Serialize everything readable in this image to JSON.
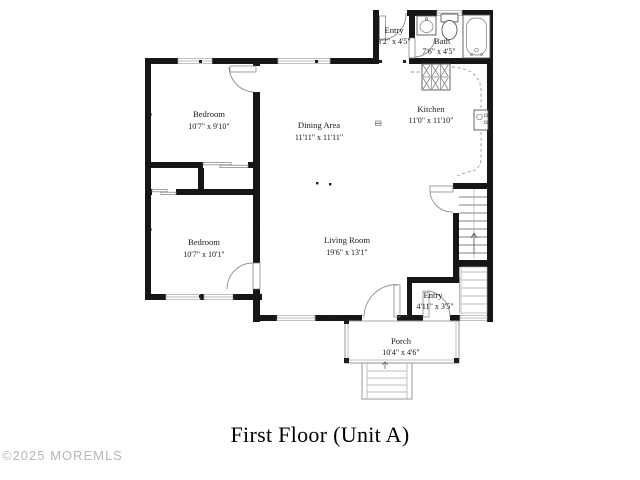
{
  "page": {
    "title": "First Floor (Unit A)",
    "watermark": "©2025 MOREMLS"
  },
  "rooms": {
    "bedroom1": {
      "name": "Bedroom",
      "dims": "10'7\" x 9'10\""
    },
    "bedroom2": {
      "name": "Bedroom",
      "dims": "10'7\" x 10'1\""
    },
    "dining": {
      "name": "Dining Area",
      "dims": "11'11\" x 11'11\""
    },
    "living": {
      "name": "Living Room",
      "dims": "19'6\" x 13'1\""
    },
    "kitchen": {
      "name": "Kitchen",
      "dims": "11'0\" x 11'10\""
    },
    "bath": {
      "name": "Bath",
      "dims": "7'6\" x 4'5\""
    },
    "entry_top": {
      "name": "Entry",
      "dims": "3'2\" x 4'5\""
    },
    "entry_bottom": {
      "name": "Entry",
      "dims": "4'11\" x 3'5\""
    },
    "porch": {
      "name": "Porch",
      "dims": "10'4\" x 4'6\""
    }
  },
  "colors": {
    "wall": "#161616",
    "thin_line": "#8f8f8f",
    "text": "#1a1a1a",
    "watermark": "#b7b7b7",
    "background": "#ffffff"
  }
}
